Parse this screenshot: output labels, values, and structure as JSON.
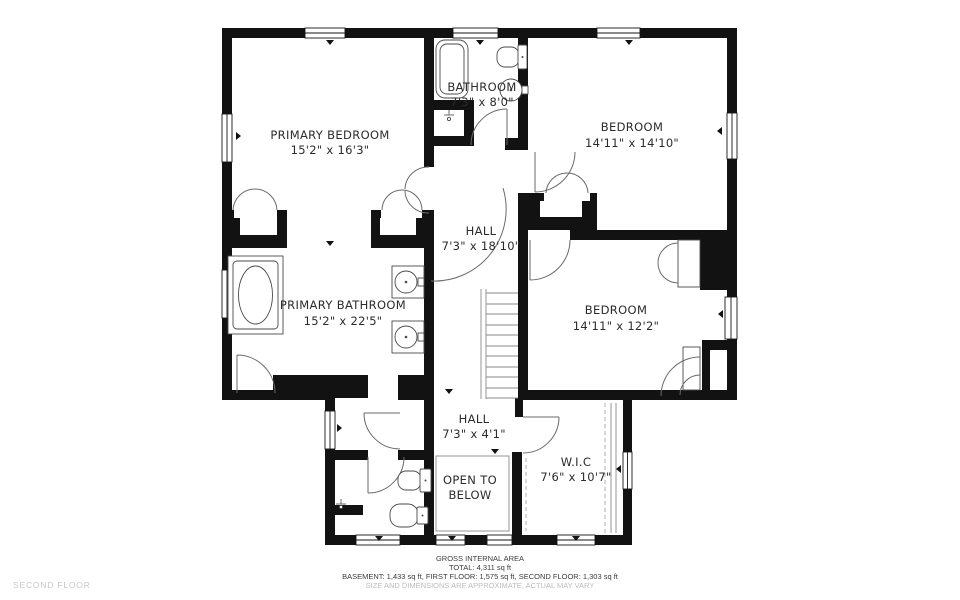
{
  "floor_plan": {
    "floor_label": "SECOND FLOOR",
    "rooms": [
      {
        "id": "primary-bedroom",
        "name": "PRIMARY BEDROOM",
        "dims": "15'2\" x 16'3\""
      },
      {
        "id": "bathroom",
        "name": "BATHROOM",
        "dims": "7'3\" x 8'0\""
      },
      {
        "id": "bedroom-1",
        "name": "BEDROOM",
        "dims": "14'11\" x 14'10\""
      },
      {
        "id": "hall",
        "name": "HALL",
        "dims": "7'3\" x 18'10\""
      },
      {
        "id": "primary-bathroom",
        "name": "PRIMARY BATHROOM",
        "dims": "15'2\" x 22'5\""
      },
      {
        "id": "bedroom-2",
        "name": "BEDROOM",
        "dims": "14'11\" x 12'2\""
      },
      {
        "id": "hall-lower",
        "name": "HALL",
        "dims": "7'3\" x 4'1\""
      },
      {
        "id": "open-to-below",
        "name": "OPEN TO",
        "dims": "BELOW"
      },
      {
        "id": "wic",
        "name": "W.I.C",
        "dims": "7'6\" x 10'7\""
      }
    ],
    "footer": {
      "title": "GROSS INTERNAL AREA",
      "total": "TOTAL: 4,311 sq ft",
      "breakdown": "BASEMENT: 1,433 sq ft, FIRST FLOOR: 1,575 sq ft, SECOND FLOOR: 1,303 sq ft",
      "disclaimer": "SIZE AND DIMENSIONS ARE APPROXIMATE, ACTUAL MAY VARY"
    },
    "colors": {
      "wall": "#121212",
      "door_line": "#6a6a6a",
      "text": "#2b2b2b",
      "muted_text": "#bcbcbc"
    }
  }
}
